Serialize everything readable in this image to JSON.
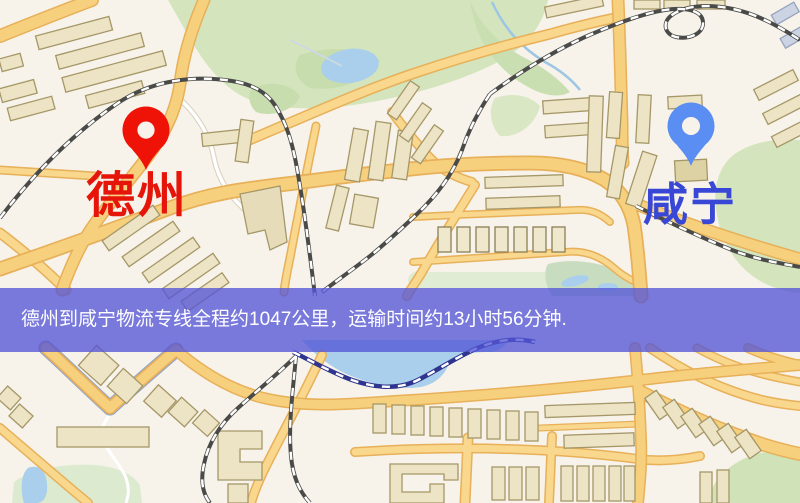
{
  "banner": {
    "text": "德州到咸宁物流专线全程约1047公里，运输时间约13小时56分钟.",
    "bg_color": "#5456d6",
    "text_color": "#ffffff"
  },
  "markers": [
    {
      "id": "origin",
      "label": "德州",
      "pin_color": "#ee1306",
      "label_color": "#e6150a"
    },
    {
      "id": "destination",
      "label": "咸宁",
      "pin_color": "#5b8ef2",
      "label_color": "#3847d6"
    }
  ],
  "map_palette": {
    "background": "#f7f3ea",
    "road_fill": "#f7d07e",
    "road_casing": "#e7b059",
    "minor_road_fill": "#f9d78c",
    "white_road": "#ffffff",
    "railway_dark": "#4a4a48",
    "railway_navy": "#2f358f",
    "water": "#a9cfec",
    "park_green": "#d4e4bd",
    "field_green": "#dcead0",
    "building_fill": "#ede4c6",
    "building_stroke": "#a59767",
    "motorway_edge": "#8fa3cc"
  }
}
